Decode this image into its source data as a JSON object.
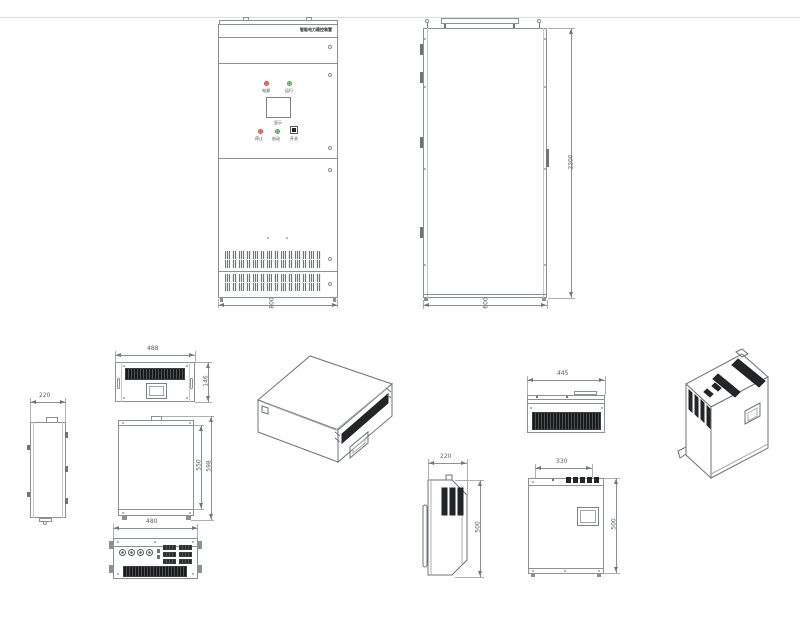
{
  "drawing": {
    "cabinet_front": {
      "nameplate": "智能电力稳控装置",
      "width_dim": "800",
      "lamps": {
        "left_label": "电源",
        "right_label": "运行"
      },
      "screen_label": "显示",
      "controls": {
        "stop_label": "停止",
        "start_label": "启动",
        "switch_label": "开关"
      }
    },
    "cabinet_side": {
      "height_dim": "2200",
      "depth_dim": "600"
    },
    "rack_unit": {
      "front_width_dim": "488",
      "front_height_dim": "146",
      "side_width_dim": "220",
      "box_height_dim": "550",
      "box_overall_height_dim": "598",
      "rear_width_dim": "480"
    },
    "wall_unit": {
      "top_width_dim": "445",
      "side_width_dim": "220",
      "side_height_dim": "500",
      "front_width_dim": "330",
      "front_height_dim": "500"
    }
  },
  "colors": {
    "line": "#8b9196",
    "dark_fill": "#232528",
    "red": "#c94a42",
    "green": "#4ea25c",
    "guide_line": "#d9e1db"
  }
}
